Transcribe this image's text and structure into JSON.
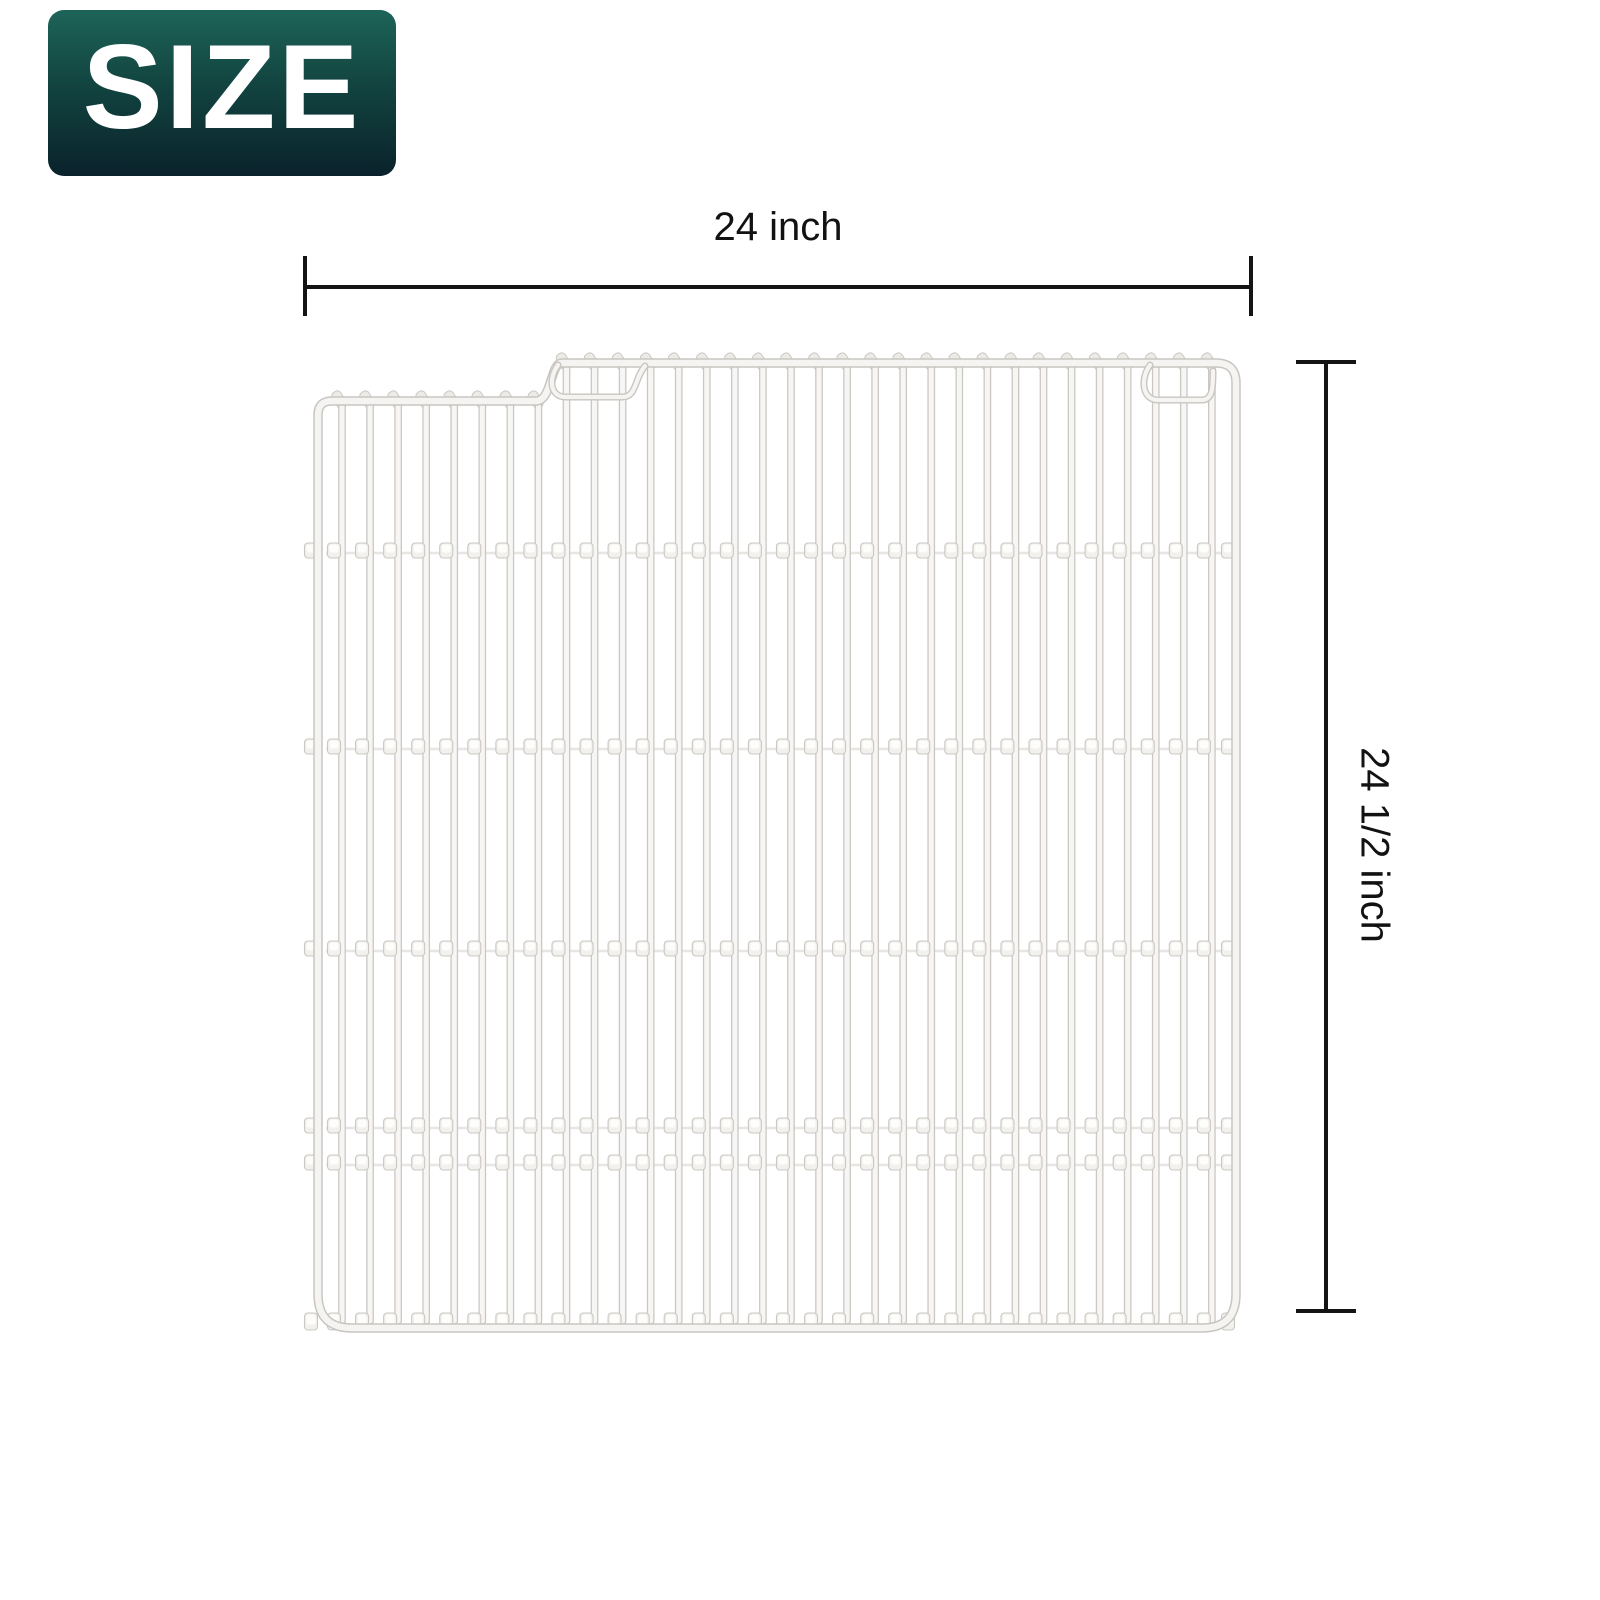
{
  "page": {
    "type": "product-size-diagram",
    "background": "#ffffff"
  },
  "badge": {
    "label": "SIZE",
    "text_color": "#ffffff",
    "gradient_top": "#1d6458",
    "gradient_mid": "#124440",
    "gradient_bottom": "#0a222b"
  },
  "dimensions": {
    "line_color": "#141414",
    "width": {
      "label": "24 inch"
    },
    "height": {
      "label": "24 1/2 inch"
    }
  },
  "product": {
    "name": "white coated wire shelf",
    "wire_fill": "#f7f6f4",
    "wire_edge": "#cbc8c3",
    "rail_fill": "#f5f4f2",
    "rail_edge": "#c9c6c1",
    "tab_fill": "#f2f1ee",
    "tab_highlight": "#fdfdfc",
    "hook_fill": "#edebe8",
    "crossbar_line": "#e8e6e2"
  }
}
